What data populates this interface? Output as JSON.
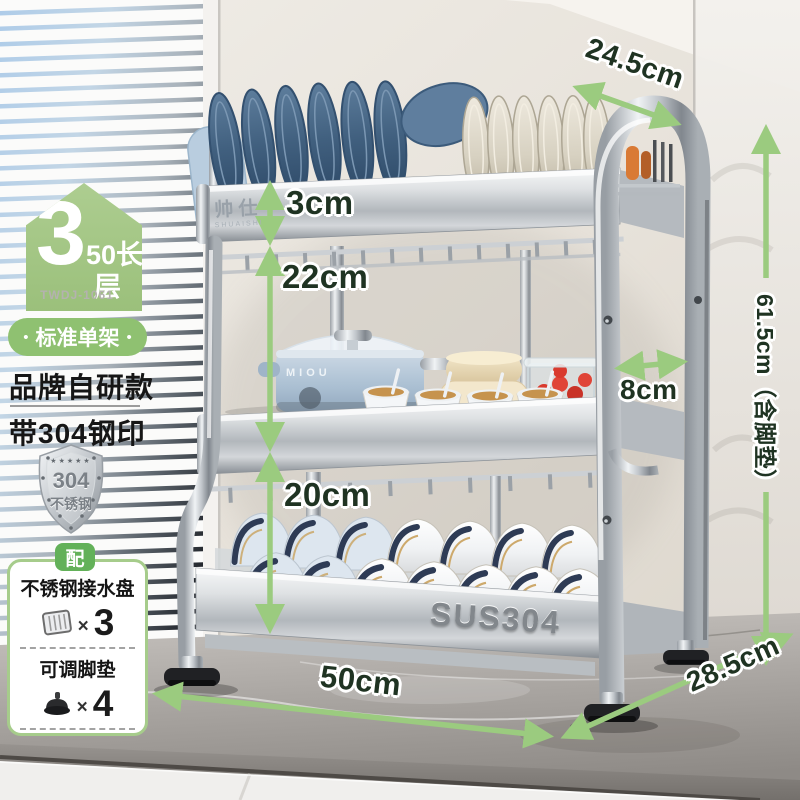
{
  "panel": {
    "badge": {
      "number": "3",
      "length_label": "50长",
      "tier_label": "层"
    },
    "model": "TWDJ-1061",
    "dot": "•",
    "variant": "标准单架",
    "feature1": "品牌自研款",
    "feature2": "带304钢印",
    "shield": {
      "stars": "★★★★★",
      "number": "304",
      "name": "不锈钢"
    },
    "included": {
      "tab": "配",
      "items": [
        {
          "name": "不锈钢接水盘",
          "times": "×",
          "qty": "3"
        },
        {
          "name": "可调脚垫",
          "times": "×",
          "qty": "4"
        }
      ]
    }
  },
  "dimensions": {
    "top_depth": "24.5cm",
    "top_panel_height": "3cm",
    "tier1_clearance": "22cm",
    "side_gap": "8cm",
    "tier2_clearance": "20cm",
    "total_height": "61.5cm（含脚垫）",
    "width": "50cm",
    "base_depth": "28.5cm"
  },
  "product": {
    "brand": "帅仕",
    "brand_en": "SHUAISHI",
    "pot_brand": "MIOU",
    "steel_stamp": "SUS304"
  },
  "colors": {
    "accent_green": "#8fc171",
    "arrow_green": "#9bcb7f",
    "dimension_text": "#1f3322",
    "badge_green": "#a3c687",
    "tab_green": "#63b159"
  }
}
